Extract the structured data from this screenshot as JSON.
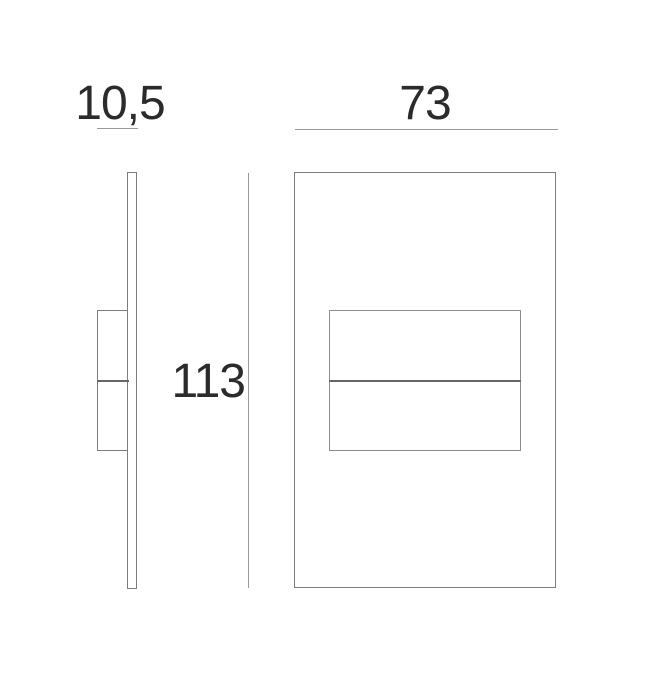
{
  "dimensions": {
    "depth": "10,5",
    "width": "73",
    "height": "113"
  },
  "colors": {
    "background": "#ffffff",
    "text": "#2b2b2b",
    "dimension_line": "#9a9a9a",
    "object_line": "#7d7d7d",
    "object_line_light": "#8d8d8d",
    "divider_line": "#666666"
  }
}
